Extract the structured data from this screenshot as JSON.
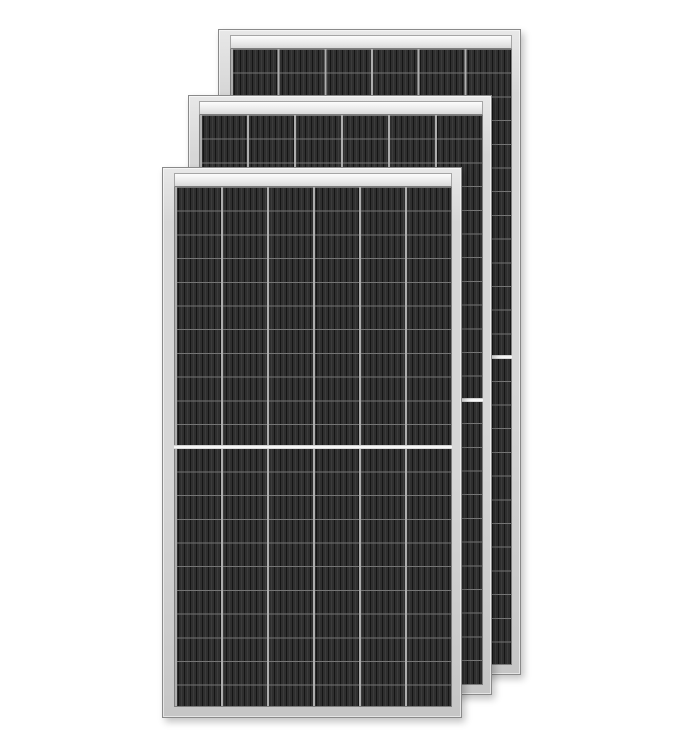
{
  "scene": {
    "kind": "product-image",
    "description": "Three black monocrystalline half-cut solar panel modules with silver aluminum frames, overlapping from back-right to front-left on a plain white background",
    "panel_count": 3
  },
  "panel_spec": {
    "cell_columns": 6,
    "cell_rows_total": 22,
    "halves": 2,
    "center_divider": "continuous white horizontal gap at mid-height of the cell field",
    "top_band": "bright silver rail directly below the top frame edge",
    "cell_pattern": "dense vertical finger stripes with light column gaps and thin gray row lines"
  },
  "panels": [
    {
      "id": "back",
      "label": "solar panel module (back)"
    },
    {
      "id": "middle",
      "label": "solar panel module (middle)"
    },
    {
      "id": "front",
      "label": "solar panel module (front)"
    }
  ],
  "palette": {
    "bg": "#ffffff",
    "frame-border": "#8a8a8a",
    "frame-hi": "#e8e8e8",
    "frame-mid": "#d6d6d6",
    "frame-lo": "#c6c6c6",
    "band-border": "#a5a5a5",
    "band-hi": "#fcfcfc",
    "band-mid": "#ebebeb",
    "band-lo": "#d9d9d9",
    "cells-border": "#7d7d7d",
    "cell-base": "#242424",
    "finger-dark": "#151515",
    "finger-lite": "#2f2f2f",
    "busbar": "#3c3c3c",
    "gap": "#aeaeae",
    "row-line": "#757575",
    "divider": "#f7f7f7",
    "divider-edge": "#bdbdbd"
  }
}
